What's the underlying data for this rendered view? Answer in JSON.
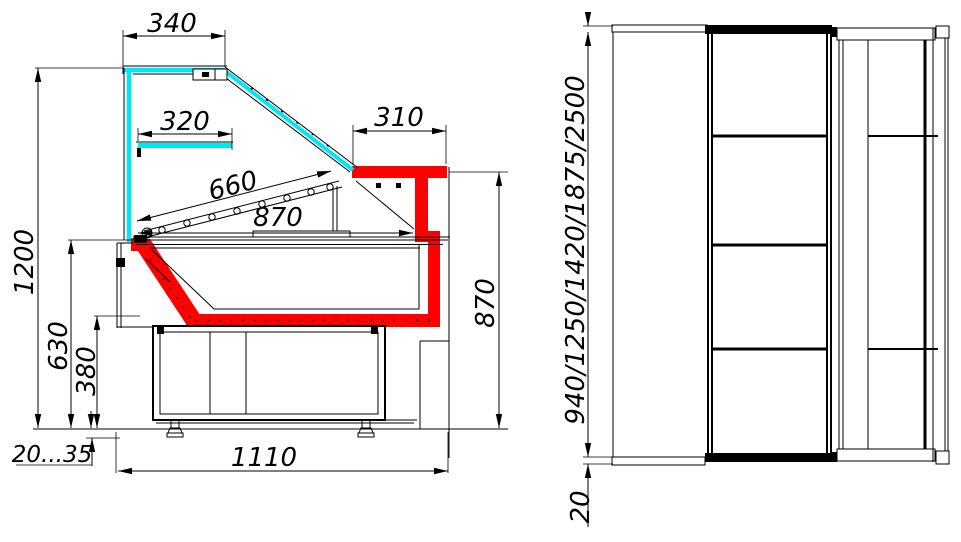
{
  "colors": {
    "highlight_red": "#ff0000",
    "glass_cyan": "#00e6f2",
    "line": "#000000",
    "paper": "#ffffff"
  },
  "section_view": {
    "dimensions": {
      "canopy_width": "340",
      "inner_shelf_width": "320",
      "rear_shelf_width": "310",
      "display_glass_length": "660",
      "deck_depth": "870",
      "overall_height": "1200",
      "worktop_height": "630",
      "base_height": "380",
      "leg_adjust_range": "20...35",
      "base_depth": "1110",
      "rear_height": "870"
    }
  },
  "plan_view": {
    "dimensions": {
      "length_options": "940/1250/1420/1875/2500",
      "end_overhang": "20"
    }
  }
}
